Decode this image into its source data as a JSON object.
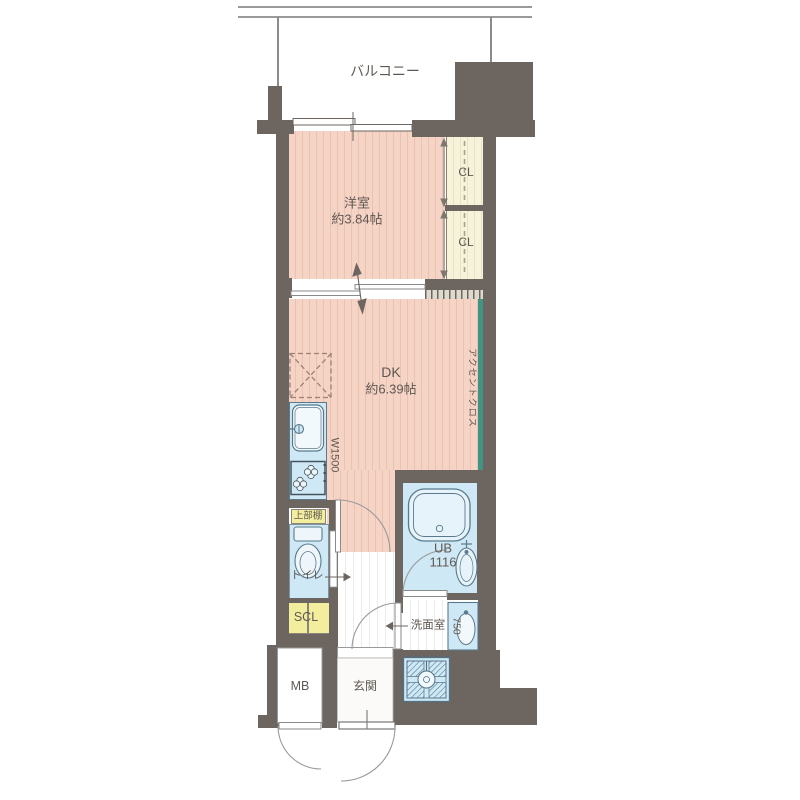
{
  "floor_plan": {
    "balcony": {
      "label": "バルコニー"
    },
    "western_room": {
      "name": "洋室",
      "area": "約3.84帖"
    },
    "dining_kitchen": {
      "name": "DK",
      "area": "約6.39帖"
    },
    "closet_upper": {
      "label": "CL"
    },
    "closet_lower": {
      "label": "CL"
    },
    "accent_wall": {
      "label": "アクセントクロス"
    },
    "kitchen": {
      "width_label": "W1500",
      "upper_shelf_label": "上部棚"
    },
    "toilet": {
      "label": "トイレ"
    },
    "shoe_closet": {
      "label": "SCL"
    },
    "unit_bath": {
      "label": "UB",
      "size": "1116"
    },
    "washroom": {
      "label": "洗面室",
      "vanity_width": "750"
    },
    "meter_box": {
      "label": "MB"
    },
    "entrance": {
      "label": "玄関"
    }
  },
  "colors": {
    "wall": "#6d655f",
    "room_pink": "#f5d3c5",
    "closet_cream": "#f6f3da",
    "water_blue": "#cfe8f5",
    "storage_yellow": "#f2ee9d",
    "accent_green": "#3f9582",
    "text": "#5f5953"
  }
}
